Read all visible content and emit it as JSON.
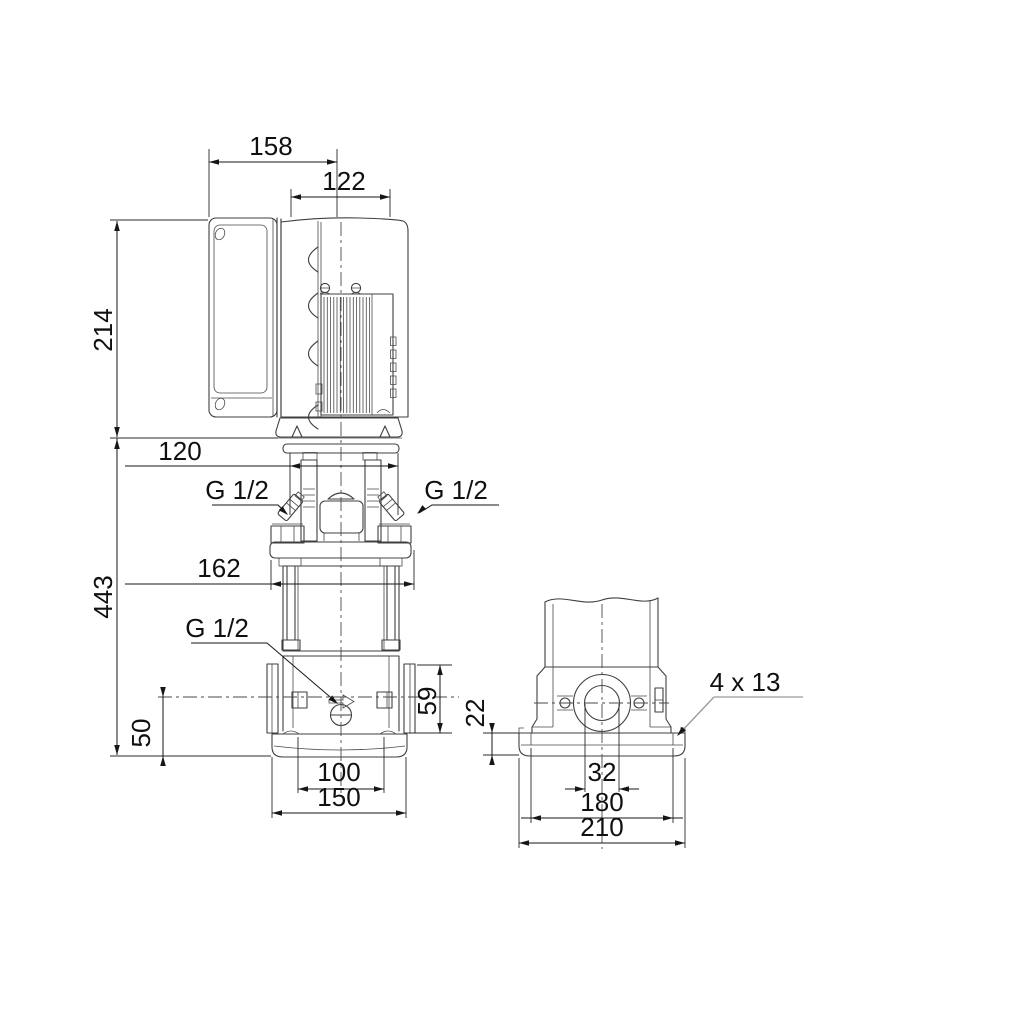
{
  "drawing": {
    "type": "technical dimensional drawing",
    "subject": "vertical multistage centrifugal pump with motor and control box, front and end elevations",
    "units": "mm"
  },
  "colors": {
    "background": "#ffffff",
    "outline": "#3f3f3f",
    "dimension": "#161616",
    "leader": "#9a9a9a"
  },
  "front_view": {
    "dim_control_box_width": "158",
    "dim_motor_width": "122",
    "dim_motor_height": "214",
    "dim_head_width": "120",
    "dim_pump_height": "443",
    "dim_flange_plate_width": "162",
    "dim_drain_height": "50",
    "dim_port_height": "59",
    "dim_port_spacing": "100",
    "dim_base_depth": "150",
    "vent_plug_left": "G 1/2",
    "vent_plug_right": "G 1/2",
    "drain_plug": "G 1/2"
  },
  "end_view": {
    "dim_base_height": "22",
    "dim_port_bore": "32",
    "dim_bolt_spacing": "180",
    "dim_base_width": "210",
    "base_holes": "4 x 13"
  }
}
